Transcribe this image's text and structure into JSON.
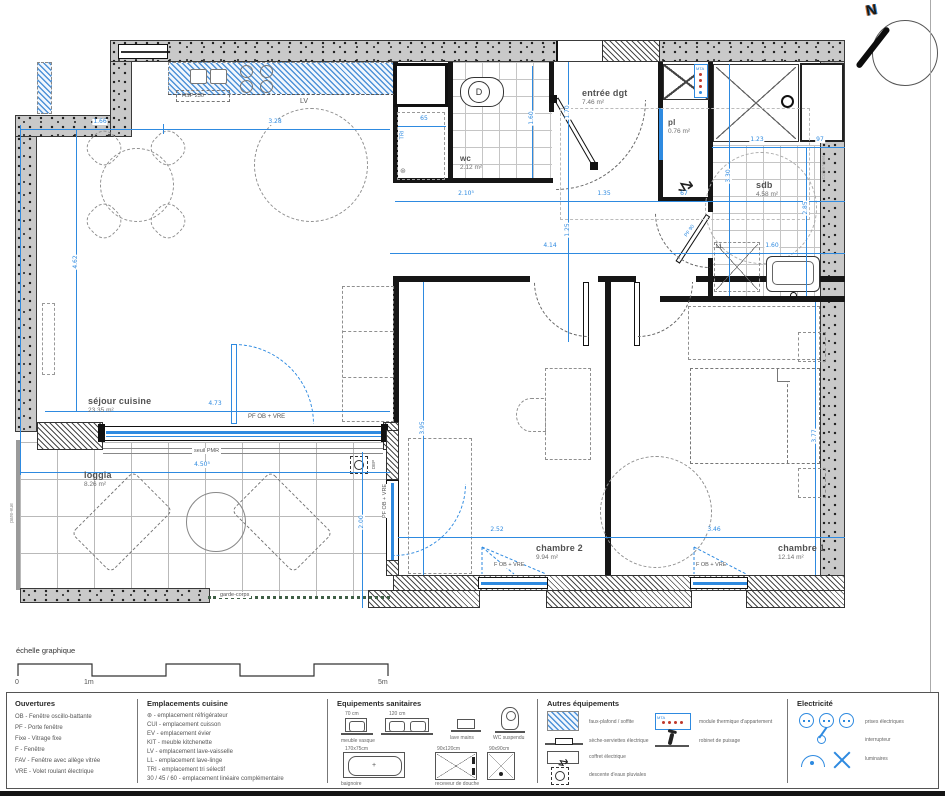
{
  "page": {
    "north_label": "N",
    "scale_title": "échelle graphique",
    "scale_ticks": [
      "0",
      "1m",
      "5m"
    ]
  },
  "rooms": [
    {
      "name": "séjour cuisine",
      "area": "23.35 m²"
    },
    {
      "name": "loggia",
      "area": "8.26 m²"
    },
    {
      "name": "wc",
      "area": "2.12 m²"
    },
    {
      "name": "entrée dgt",
      "area": "7.46 m²"
    },
    {
      "name": "pl",
      "area": "0.76 m²"
    },
    {
      "name": "sdb",
      "area": "4.58 m²"
    },
    {
      "name": "chambre 2",
      "area": "9.94 m²"
    },
    {
      "name": "chambre 1",
      "area": "12.14 m²"
    }
  ],
  "annotations": {
    "hsp": "HSP 230",
    "lv": "LV",
    "tri": "TRI",
    "ll": "LL",
    "d": "D",
    "mta": "MTA",
    "dep": "DEP",
    "pf90": "PF 90",
    "pf_ob_vre_h": "PF OB + VRE",
    "pf_ob_vre_w": "PF OB + VRE",
    "f_ob_vre_c2": "F OB + VRE",
    "f_ob_vre_c1": "F OB + VRE",
    "seuil_pmr": "seuil PMR",
    "garde_corps": "garde-corps",
    "coffre_volet": "Coffre Volet",
    "pare_vue": "pare-vue",
    "fridge_icon": "⊛",
    "zigzag_icon": "↯"
  },
  "dims": {
    "d166": "1.66",
    "d328": "3.28",
    "d462": "4.62",
    "d2105": "2.10⁵",
    "d135": "1.35",
    "d67": "67",
    "d414": "4.14",
    "d160s": "1.60",
    "d123": "1.23",
    "d97": "97",
    "d330": "3.30",
    "d285": "2.85",
    "d160w": "1.60",
    "d170": "1.70",
    "d125": "1.25",
    "d65": "65",
    "d473": "4.73",
    "d450": "4.50⁵",
    "d200": "2.00",
    "d395": "3.95",
    "d252": "2.52",
    "d346": "3.46",
    "d377": "3.77"
  },
  "legend": {
    "ouvertures": {
      "title": "Ouvertures",
      "items": [
        "OB - Fenêtre oscillo-battante",
        "PF - Porte fenêtre",
        "Fixe - Vitrage fixe",
        "F - Fenêtre",
        "FAV - Fenêtre avec allège vitrée",
        "VRE - Volet roulant électrique"
      ]
    },
    "cuisine": {
      "title": "Emplacements cuisine",
      "items": [
        "⊛ - emplacement réfrigérateur",
        "CUI - emplacement cuisson",
        "EV - emplacement évier",
        "KIT - meuble kitchenette",
        "LV - emplacement lave-vaisselle",
        "LL - emplacement lave-linge",
        "TRI - emplacement tri sélectif",
        "30 / 45 / 60 - emplacement linéaire complémentaire"
      ]
    },
    "sanitaires": {
      "title": "Equipements sanitaires",
      "labels": {
        "vasque70": "70 cm",
        "vasque120": "120 cm",
        "meuble_vasque": "meuble vasque",
        "lave_mains": "lave mains",
        "wc_susp": "WC suspendu",
        "baignoire_dim": "170x75cm",
        "baignoire": "baignoire",
        "douche120": "90x120cm",
        "douche90": "90x90cm",
        "receveur": "receveur de douche"
      }
    },
    "autres": {
      "title": "Autres équipements",
      "items": [
        "faux-plafond / soffite",
        "sèche-serviettes électrique",
        "coffret électrique",
        "descente d'eaux pluviales",
        "module thermique d'appartement",
        "robinet de puisage"
      ],
      "mta": "MTA"
    },
    "electricite": {
      "title": "Electricité",
      "items": [
        "prises électriques",
        "interrupteur",
        "luminaires"
      ]
    }
  }
}
